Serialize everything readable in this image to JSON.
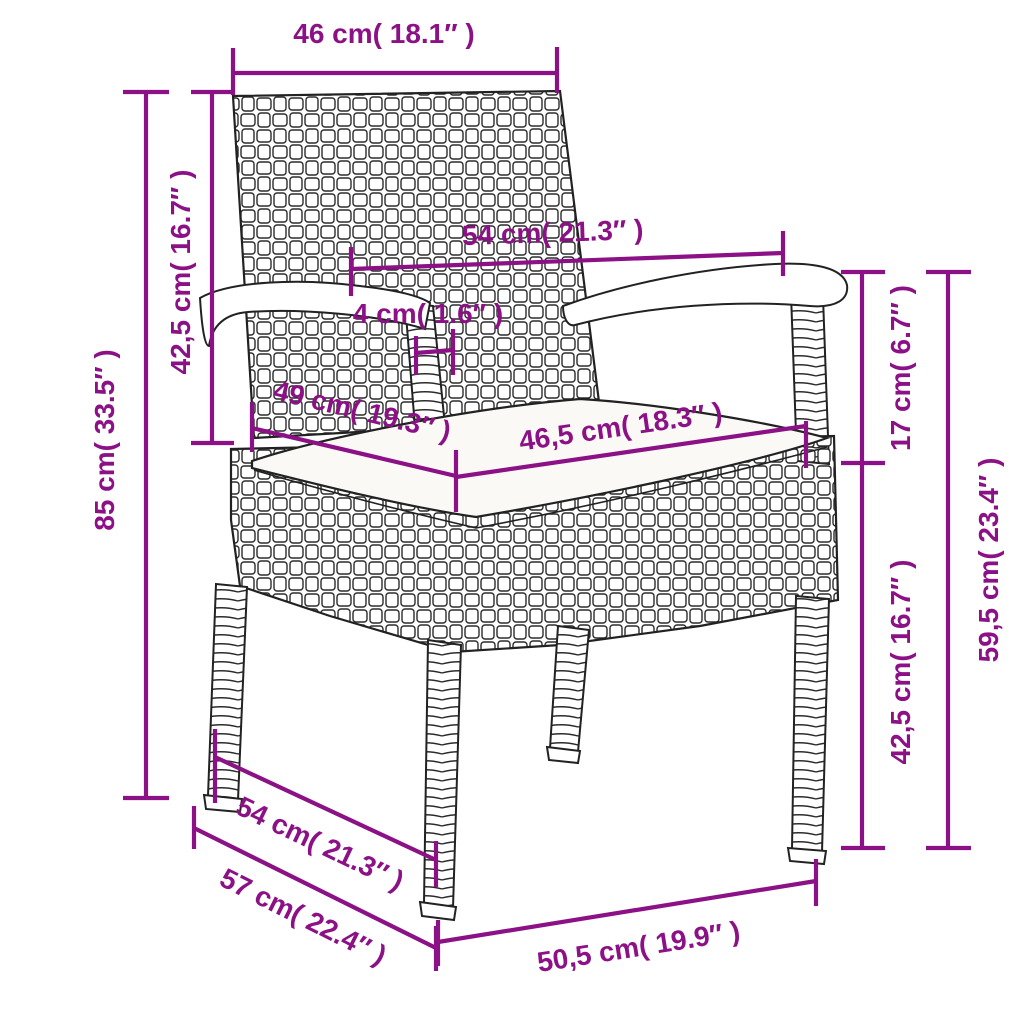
{
  "title": "Rattan garden chair dimension diagram",
  "colors": {
    "dimension_accent": "#8c1186",
    "line_ink": "#222222",
    "background": "#ffffff",
    "cushion": "#fbf9f5"
  },
  "dimensions": [
    {
      "id": "backrest-top-width",
      "label": "46 cm( 18.1″ )"
    },
    {
      "id": "backrest-height",
      "label": "42,5 cm( 16.7″ )"
    },
    {
      "id": "total-height",
      "label": "85 cm( 33.5″ )"
    },
    {
      "id": "armrest-span",
      "label": "54 cm( 21.3″ )"
    },
    {
      "id": "armrest-thickness",
      "label": "4 cm( 1.6″ )"
    },
    {
      "id": "seat-depth",
      "label": "49 cm( 19.3″ )"
    },
    {
      "id": "seat-inner-width",
      "label": "46,5 cm( 18.3″ )"
    },
    {
      "id": "arm-above-seat",
      "label": "17 cm( 6.7″ )"
    },
    {
      "id": "seat-height",
      "label": "42,5 cm( 16.7″ )"
    },
    {
      "id": "armrest-height",
      "label": "59,5 cm( 23.4″ )"
    },
    {
      "id": "base-depth",
      "label": "54 cm( 21.3″ )"
    },
    {
      "id": "base-depth-outer",
      "label": "57 cm( 22.4″ )"
    },
    {
      "id": "base-front-width",
      "label": "50,5 cm( 19.9″ )"
    }
  ]
}
